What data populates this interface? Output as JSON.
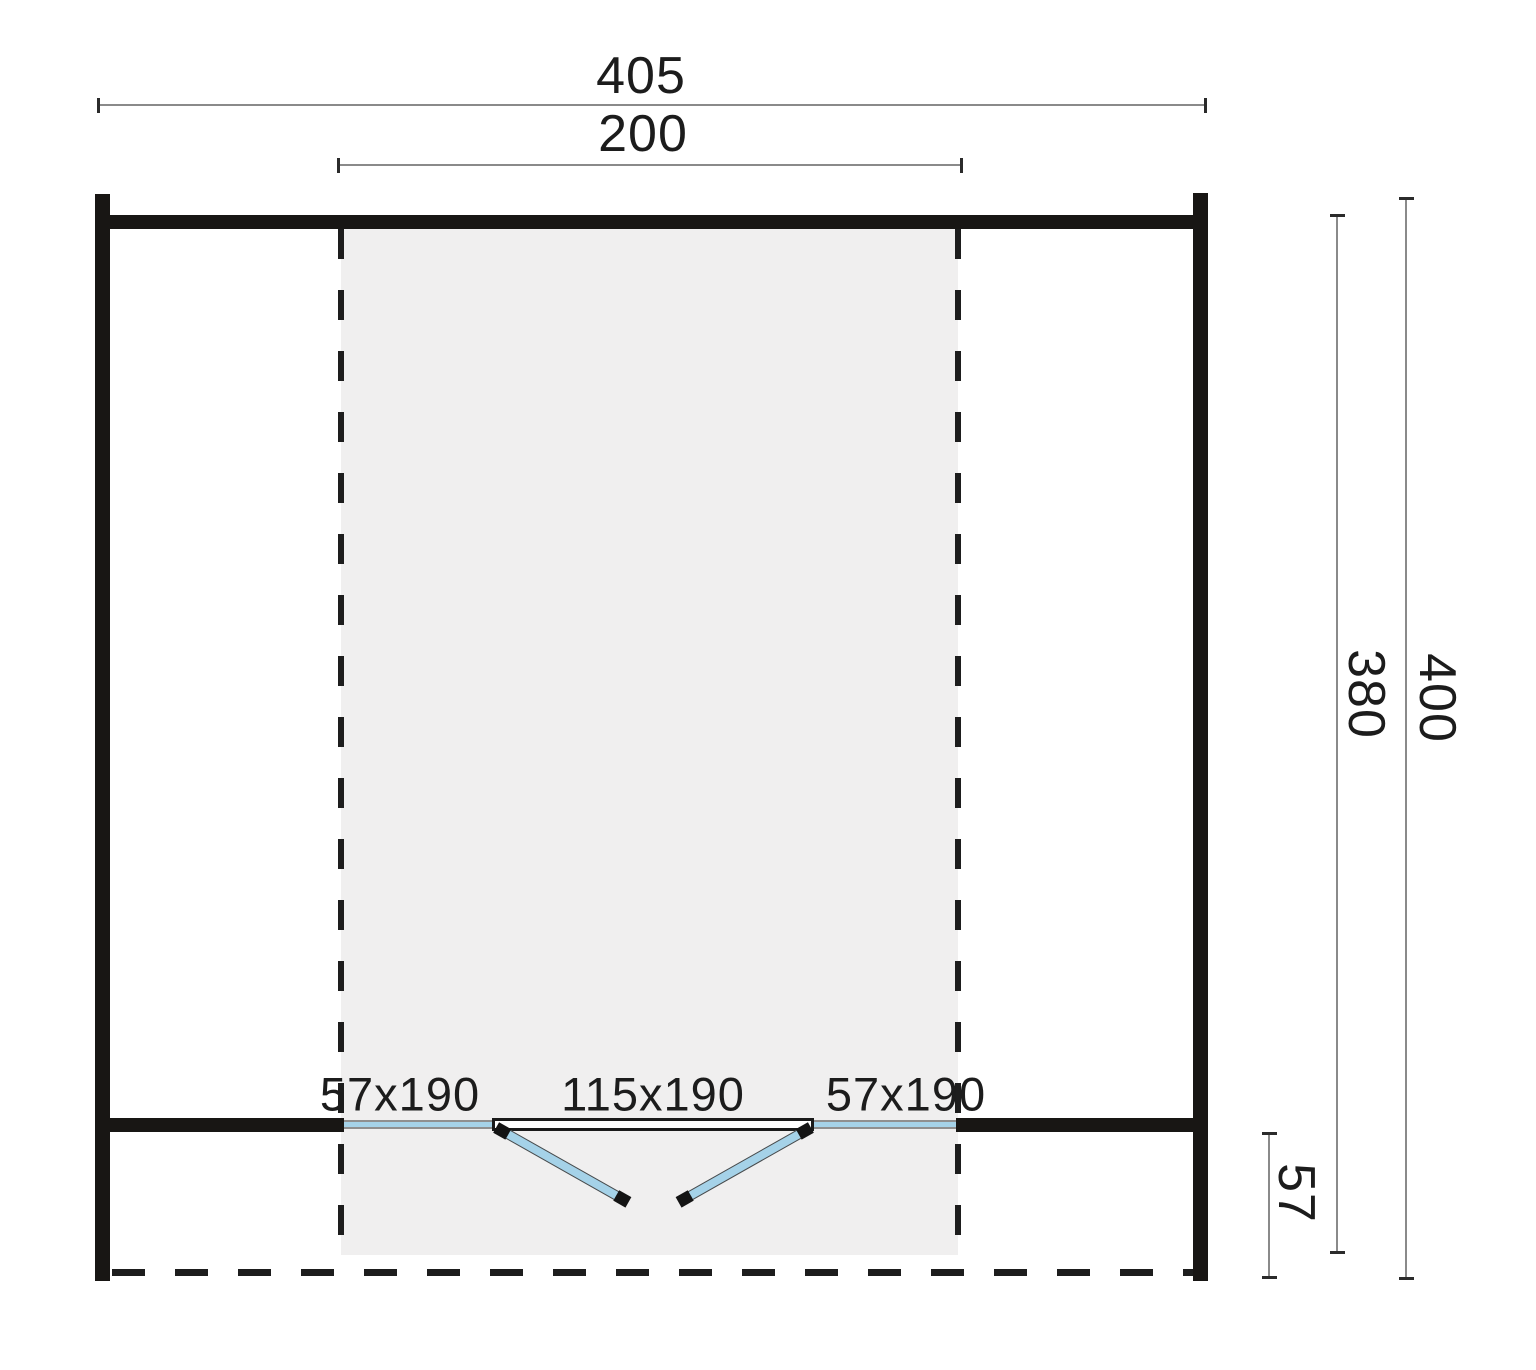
{
  "diagram": {
    "type": "log-cabin-floor-plan",
    "dimensions": {
      "top_outer": "405",
      "top_inner": "200",
      "right_inner": "380",
      "right_outer": "400",
      "bottom_right": "57"
    },
    "openings": {
      "window_left": "57x190",
      "door": "115x190",
      "window_right": "57x190"
    },
    "colors": {
      "wall": "#181614",
      "glazing": "#a5d2e8",
      "shaded_area": "#f0efef",
      "dimension_line": "#8a8a8a",
      "text": "#1c1c1c"
    }
  }
}
